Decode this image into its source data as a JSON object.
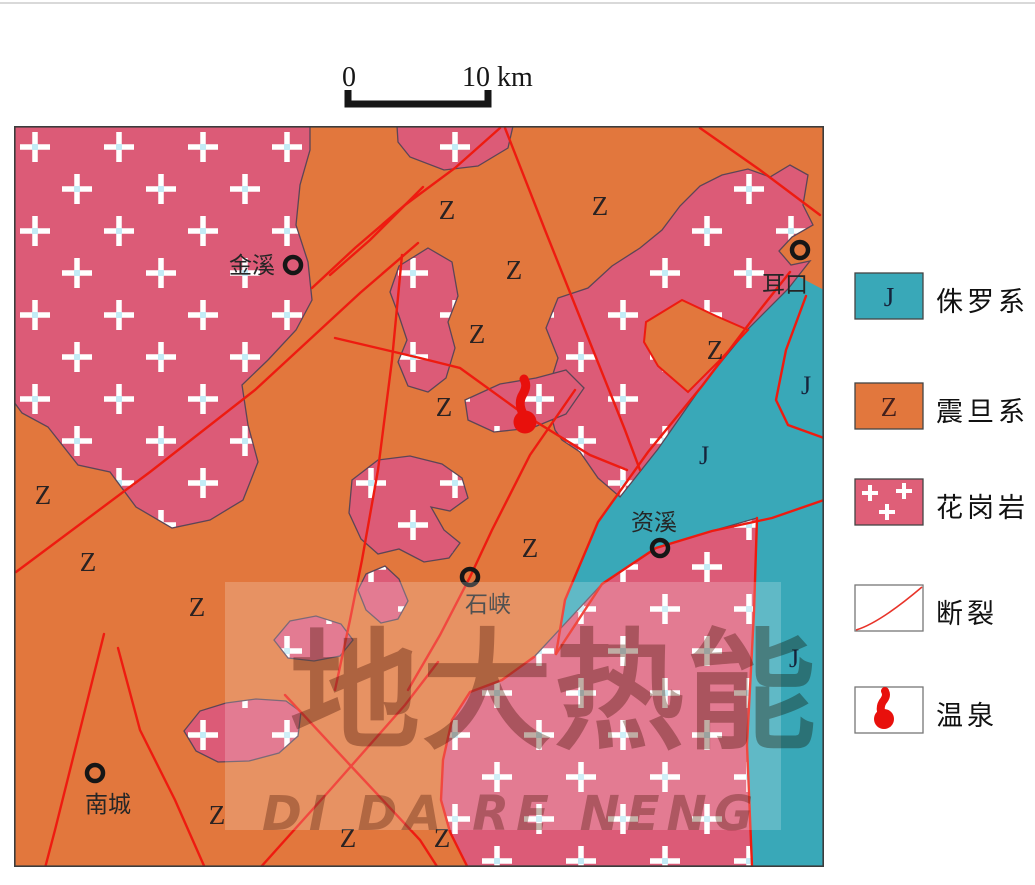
{
  "scale_bar": {
    "zero": "0",
    "ten_km": "10 km"
  },
  "map": {
    "colors": {
      "sinian_orange": "#e2773d",
      "granite_pink": "#dc5b77",
      "jurassic_teal": "#39a8b8",
      "fault_red": "#ee1b10",
      "spring_red": "#e8100c",
      "outline": "#5c4556"
    },
    "unit_labels": {
      "sinian": "Z",
      "jurassic": "J"
    },
    "towns": [
      {
        "name": "金溪"
      },
      {
        "name": "耳口"
      },
      {
        "name": "资溪"
      },
      {
        "name": "石峡"
      },
      {
        "name": "南城"
      }
    ]
  },
  "legend": {
    "items": [
      {
        "key": "J",
        "label": "侏罗系"
      },
      {
        "key": "Z",
        "label": "震旦系"
      },
      {
        "key": "",
        "label": "花岗岩"
      },
      {
        "key": "",
        "label": "断裂"
      },
      {
        "key": "",
        "label": "温泉"
      }
    ]
  },
  "watermark": {
    "title": "地大热能",
    "subtitle": "DI DA RE NENG"
  }
}
